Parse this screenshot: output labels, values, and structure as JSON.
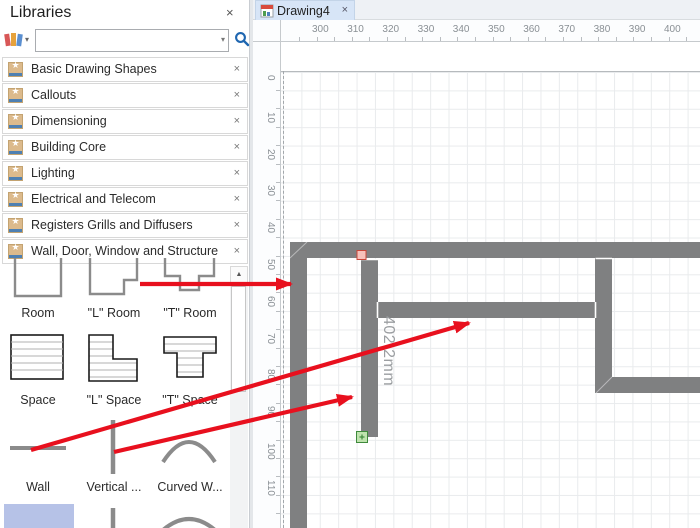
{
  "panel": {
    "title": "Libraries",
    "close_glyph": "×",
    "toolbar": {
      "library_dropdown_icon": "books-icon",
      "dropdown_glyph": "▾",
      "search_value": "",
      "search_icon": "magnifier-icon"
    },
    "library_icon_glyph": "★",
    "item_close_glyph": "×",
    "libraries": [
      {
        "label": "Basic Drawing Shapes"
      },
      {
        "label": "Callouts"
      },
      {
        "label": "Dimensioning"
      },
      {
        "label": "Building Core"
      },
      {
        "label": "Lighting"
      },
      {
        "label": "Electrical and Telecom"
      },
      {
        "label": "Registers Grills and Diffusers"
      },
      {
        "label": "Wall, Door, Window and Structure"
      }
    ],
    "shapes": [
      {
        "label": "Room"
      },
      {
        "label": "\"L\" Room"
      },
      {
        "label": "\"T\" Room"
      },
      {
        "label": "Space"
      },
      {
        "label": "\"L\" Space"
      },
      {
        "label": "\"T\" Space"
      },
      {
        "label": "Wall"
      },
      {
        "label": "Vertical ..."
      },
      {
        "label": "Curved W..."
      }
    ],
    "scrollbar_up_glyph": "▲"
  },
  "document_tab": {
    "title": "Drawing4",
    "close_glyph": "×"
  },
  "rulers": {
    "horizontal": [
      300,
      310,
      320,
      330,
      340,
      350,
      360,
      370,
      380,
      390,
      400
    ],
    "vertical": [
      0,
      10,
      20,
      30,
      40,
      50,
      60,
      70,
      80,
      90,
      100,
      110
    ]
  },
  "drawing": {
    "dimension_label": "402.2mm",
    "walls": [
      {
        "x1": 290,
        "y1": 250,
        "x2": 700,
        "y2": 250,
        "t": 16
      },
      {
        "x1": 298.5,
        "y1": 242,
        "x2": 298.5,
        "y2": 528,
        "t": 17
      },
      {
        "x1": 369.5,
        "y1": 259,
        "x2": 369.5,
        "y2": 437,
        "t": 17
      },
      {
        "x1": 378,
        "y1": 310,
        "x2": 595,
        "y2": 310,
        "t": 16
      },
      {
        "x1": 603.5,
        "y1": 258,
        "x2": 603.5,
        "y2": 393,
        "t": 17
      },
      {
        "x1": 596,
        "y1": 385,
        "x2": 700,
        "y2": 385,
        "t": 16
      }
    ],
    "seams": [
      {
        "x1": 361,
        "y1": 259.5,
        "x2": 378,
        "y2": 259.5
      },
      {
        "x1": 377.5,
        "y1": 302,
        "x2": 377.5,
        "y2": 318
      },
      {
        "x1": 595.5,
        "y1": 302,
        "x2": 595.5,
        "y2": 318
      },
      {
        "x1": 595.5,
        "y1": 258.5,
        "x2": 612,
        "y2": 258.5
      }
    ],
    "miters": [
      {
        "x1": 290,
        "y1": 258,
        "x2": 307,
        "y2": 242
      },
      {
        "x1": 596,
        "y1": 393,
        "x2": 612,
        "y2": 377
      }
    ],
    "handles": {
      "red": {
        "x": 357,
        "y": 250.5,
        "size": 9
      },
      "green": {
        "x": 356.5,
        "y": 431.5,
        "size": 11
      }
    }
  },
  "annotations": {
    "arrows": [
      {
        "x1": 140,
        "y1": 284,
        "x2": 291,
        "y2": 284
      },
      {
        "x1": 31,
        "y1": 450,
        "x2": 469,
        "y2": 323
      },
      {
        "x1": 114,
        "y1": 452,
        "x2": 352,
        "y2": 397
      }
    ]
  },
  "colors": {
    "wall": "#7f8081",
    "arrow": "#e8101e",
    "selected_shape_bg": "#b6c2e7",
    "tab_bg": "#d7e5f7",
    "accent_blue": "#1f66b0",
    "grid": "#e9ebed",
    "shape_gray": "#8b8b8b"
  }
}
